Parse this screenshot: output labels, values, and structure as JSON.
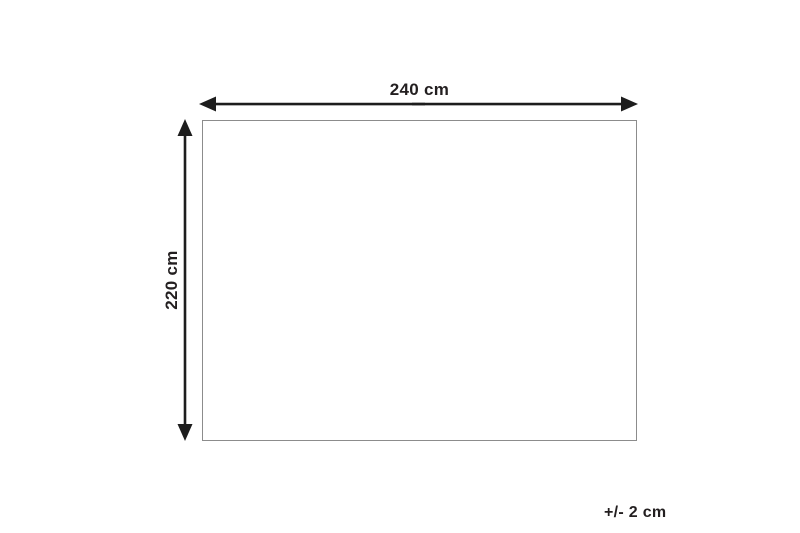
{
  "diagram": {
    "type": "product-dimension-diagram",
    "width_label": "240 cm",
    "height_label": "220 cm",
    "tolerance_label": "+/- 2 cm",
    "width_value_cm": 240,
    "height_value_cm": 220,
    "tolerance_value_cm": 2
  },
  "colors": {
    "background": "#ffffff",
    "arrow": "#1d1d1d",
    "text": "#231f20",
    "rect_outline": "#8c8c8c"
  }
}
